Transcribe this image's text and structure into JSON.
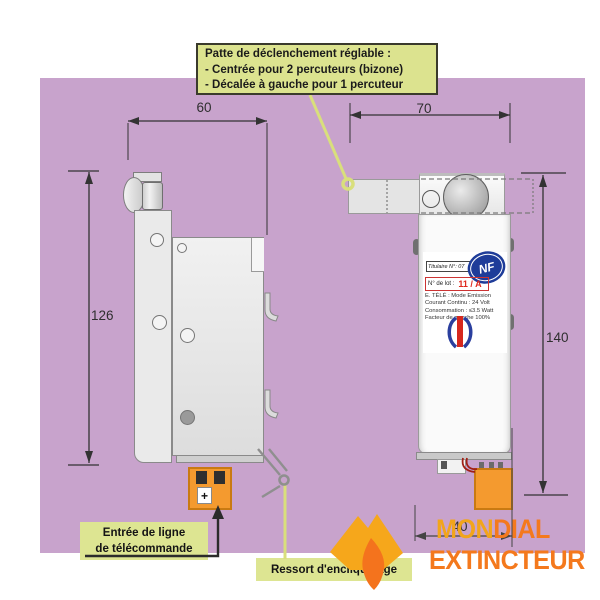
{
  "callout": {
    "title": "Patte de déclenchement réglable :",
    "line1": "- Centrée pour 2 percuteurs (bizone)",
    "line2": "- Décalée à gauche pour 1 percuteur"
  },
  "dimensions": {
    "side_width": "60",
    "front_width": "70",
    "side_height": "126",
    "front_height": "140",
    "bottom_width": "40"
  },
  "labels": {
    "entree_line1": "Entrée de ligne",
    "entree_line2": "de télécommande",
    "plus": "+",
    "spring": "Ressort d'encliquetage"
  },
  "device_label": {
    "titulaire": "Titulaire N°: 07",
    "nf": "NF",
    "lot_label": "N° de lot :",
    "lot_value": "11 / A",
    "specs": [
      "E. TÉLÉ : Mode Emission",
      "Courant Continu : 24 Volt",
      "Consommation : ≤3.5 Watt",
      "Facteur de marche 100%"
    ]
  },
  "brand": {
    "word1_part1": "MON",
    "word1_part2": "DIAL",
    "word2": "EXTINCTEUR"
  },
  "colors": {
    "background_panel": "#c8a3cc",
    "callout_fill": "#dce38f",
    "leader_yellow": "#d9df7c",
    "connector_orange": "#f49a2f",
    "brand_orange": "#f4791d",
    "brand_gold": "#f2a51b",
    "nf_blue": "#1e3c99",
    "lot_red": "#e02a1f"
  }
}
